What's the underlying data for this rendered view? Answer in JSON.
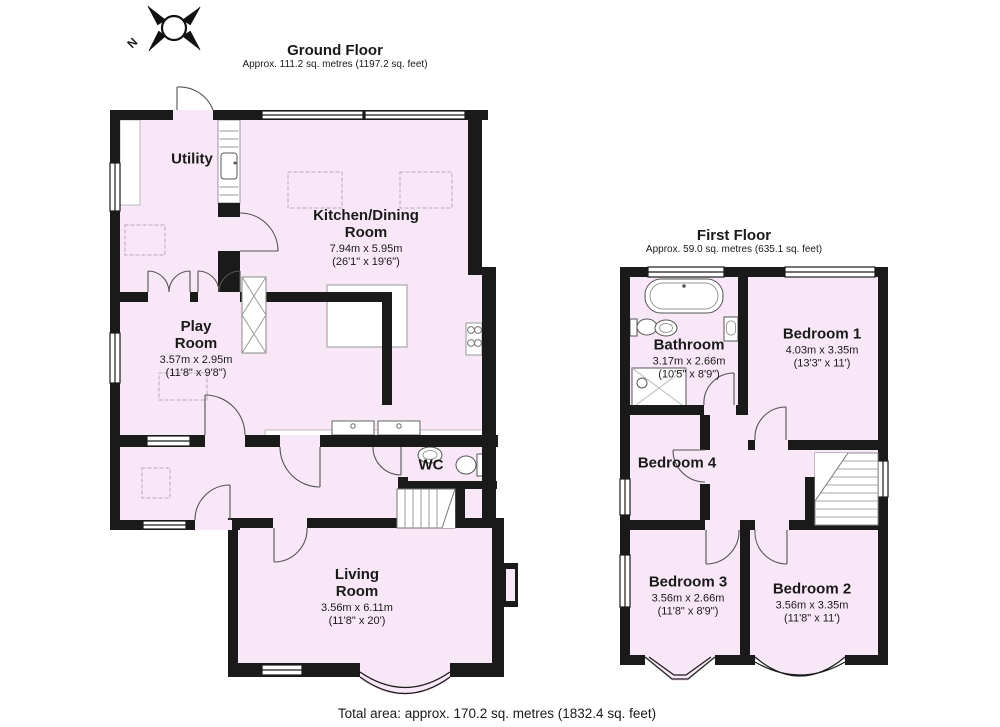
{
  "page": {
    "background": "#ffffff",
    "wall_color": "#1a1a1a",
    "room_fill": "#f8e7f6",
    "total_area_label": "Total area: approx. 170.2 sq. metres (1832.4 sq. feet)"
  },
  "compass": {
    "label": "N"
  },
  "floors": [
    {
      "title": "Ground Floor",
      "subtitle": "Approx. 111.2 sq. metres (1197.2 sq. feet)",
      "rooms": [
        {
          "name": "Utility"
        },
        {
          "name": "Kitchen/Dining\nRoom",
          "dims_m": "7.94m x 5.95m",
          "dims_ft": "(26'1\" x 19'6\")"
        },
        {
          "name": "Play\nRoom",
          "dims_m": "3.57m x 2.95m",
          "dims_ft": "(11'8\" x 9'8\")"
        },
        {
          "name": "WC"
        },
        {
          "name": "Living\nRoom",
          "dims_m": "3.56m x 6.11m",
          "dims_ft": "(11'8\" x 20')"
        }
      ]
    },
    {
      "title": "First Floor",
      "subtitle": "Approx. 59.0 sq. metres (635.1 sq. feet)",
      "rooms": [
        {
          "name": "Bathroom",
          "dims_m": "3.17m x 2.66m",
          "dims_ft": "(10'5\" x 8'9\")"
        },
        {
          "name": "Bedroom 1",
          "dims_m": "4.03m x 3.35m",
          "dims_ft": "(13'3\" x 11')"
        },
        {
          "name": "Bedroom 4"
        },
        {
          "name": "Bedroom 3",
          "dims_m": "3.56m x 2.66m",
          "dims_ft": "(11'8\" x 8'9\")"
        },
        {
          "name": "Bedroom 2",
          "dims_m": "3.56m x 3.35m",
          "dims_ft": "(11'8\" x 11')"
        }
      ]
    }
  ]
}
